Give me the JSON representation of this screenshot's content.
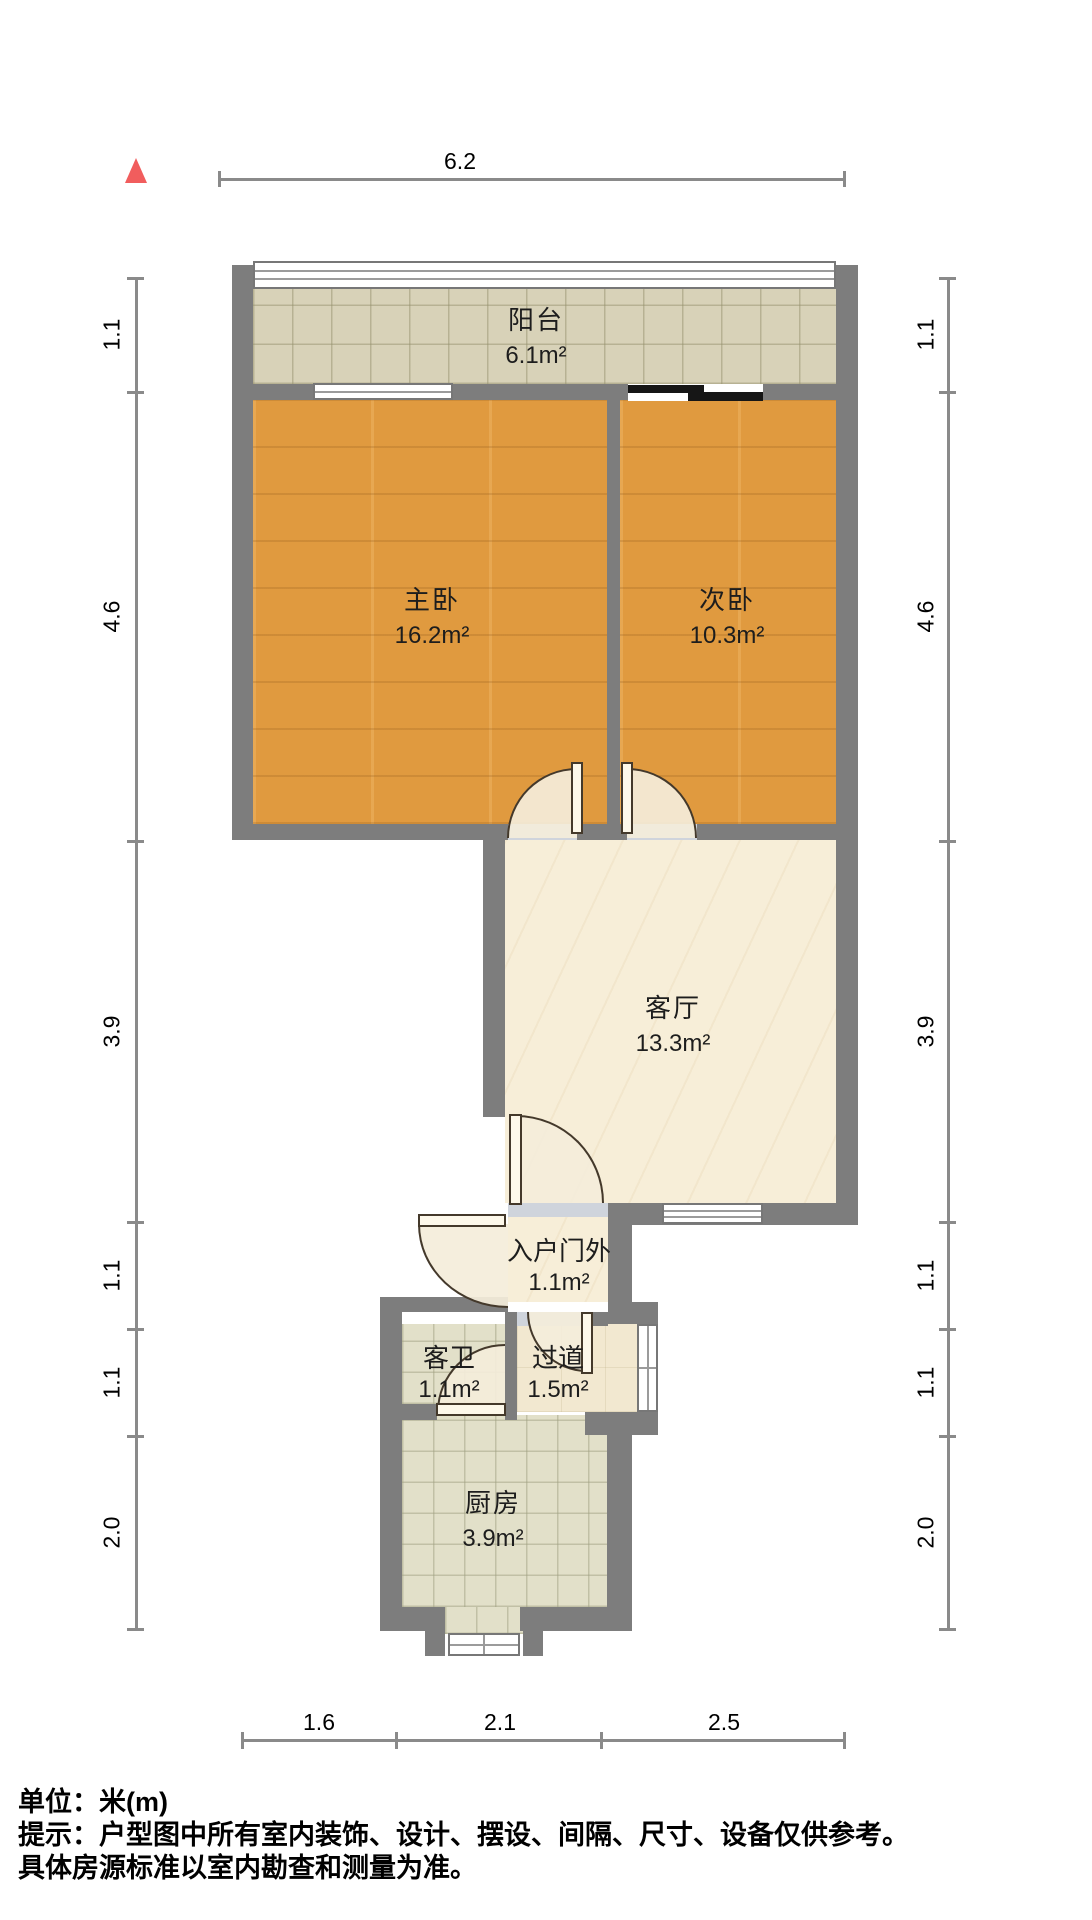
{
  "plan": {
    "type": "floor-plan",
    "north_marker": "north-arrow",
    "rooms": [
      {
        "name": "阳台",
        "area": "6.1m²"
      },
      {
        "name": "主卧",
        "area": "16.2m²"
      },
      {
        "name": "次卧",
        "area": "10.3m²"
      },
      {
        "name": "客厅",
        "area": "13.3m²"
      },
      {
        "name": "入户门外",
        "area": "1.1m²"
      },
      {
        "name": "客卫",
        "area": "1.1m²"
      },
      {
        "name": "过道",
        "area": "1.5m²"
      },
      {
        "name": "厨房",
        "area": "3.9m²"
      }
    ]
  },
  "dims": {
    "top": "6.2",
    "bottom": [
      "1.6",
      "2.1",
      "2.5"
    ],
    "side": [
      "1.1",
      "4.6",
      "3.9",
      "1.1",
      "1.1",
      "2.0"
    ]
  },
  "footer": {
    "line1": "单位：米(m)",
    "line2": "提示：户型图中所有室内装饰、设计、摆设、间隔、尺寸、设备仅供参考。",
    "line3": "具体房源标准以室内勘查和测量为准。"
  },
  "colors": {
    "wall": "#7d7d7d",
    "wood_floor": "#e09a3f",
    "balcony_tile": "#d8d2b8",
    "marble_floor": "#f7eed8",
    "kitchen_tile": "#e2e0c9",
    "north_arrow": "#f15d5d",
    "sliding_door": "#161616",
    "dimension_line": "#8a8a8a",
    "text": "#000000"
  }
}
